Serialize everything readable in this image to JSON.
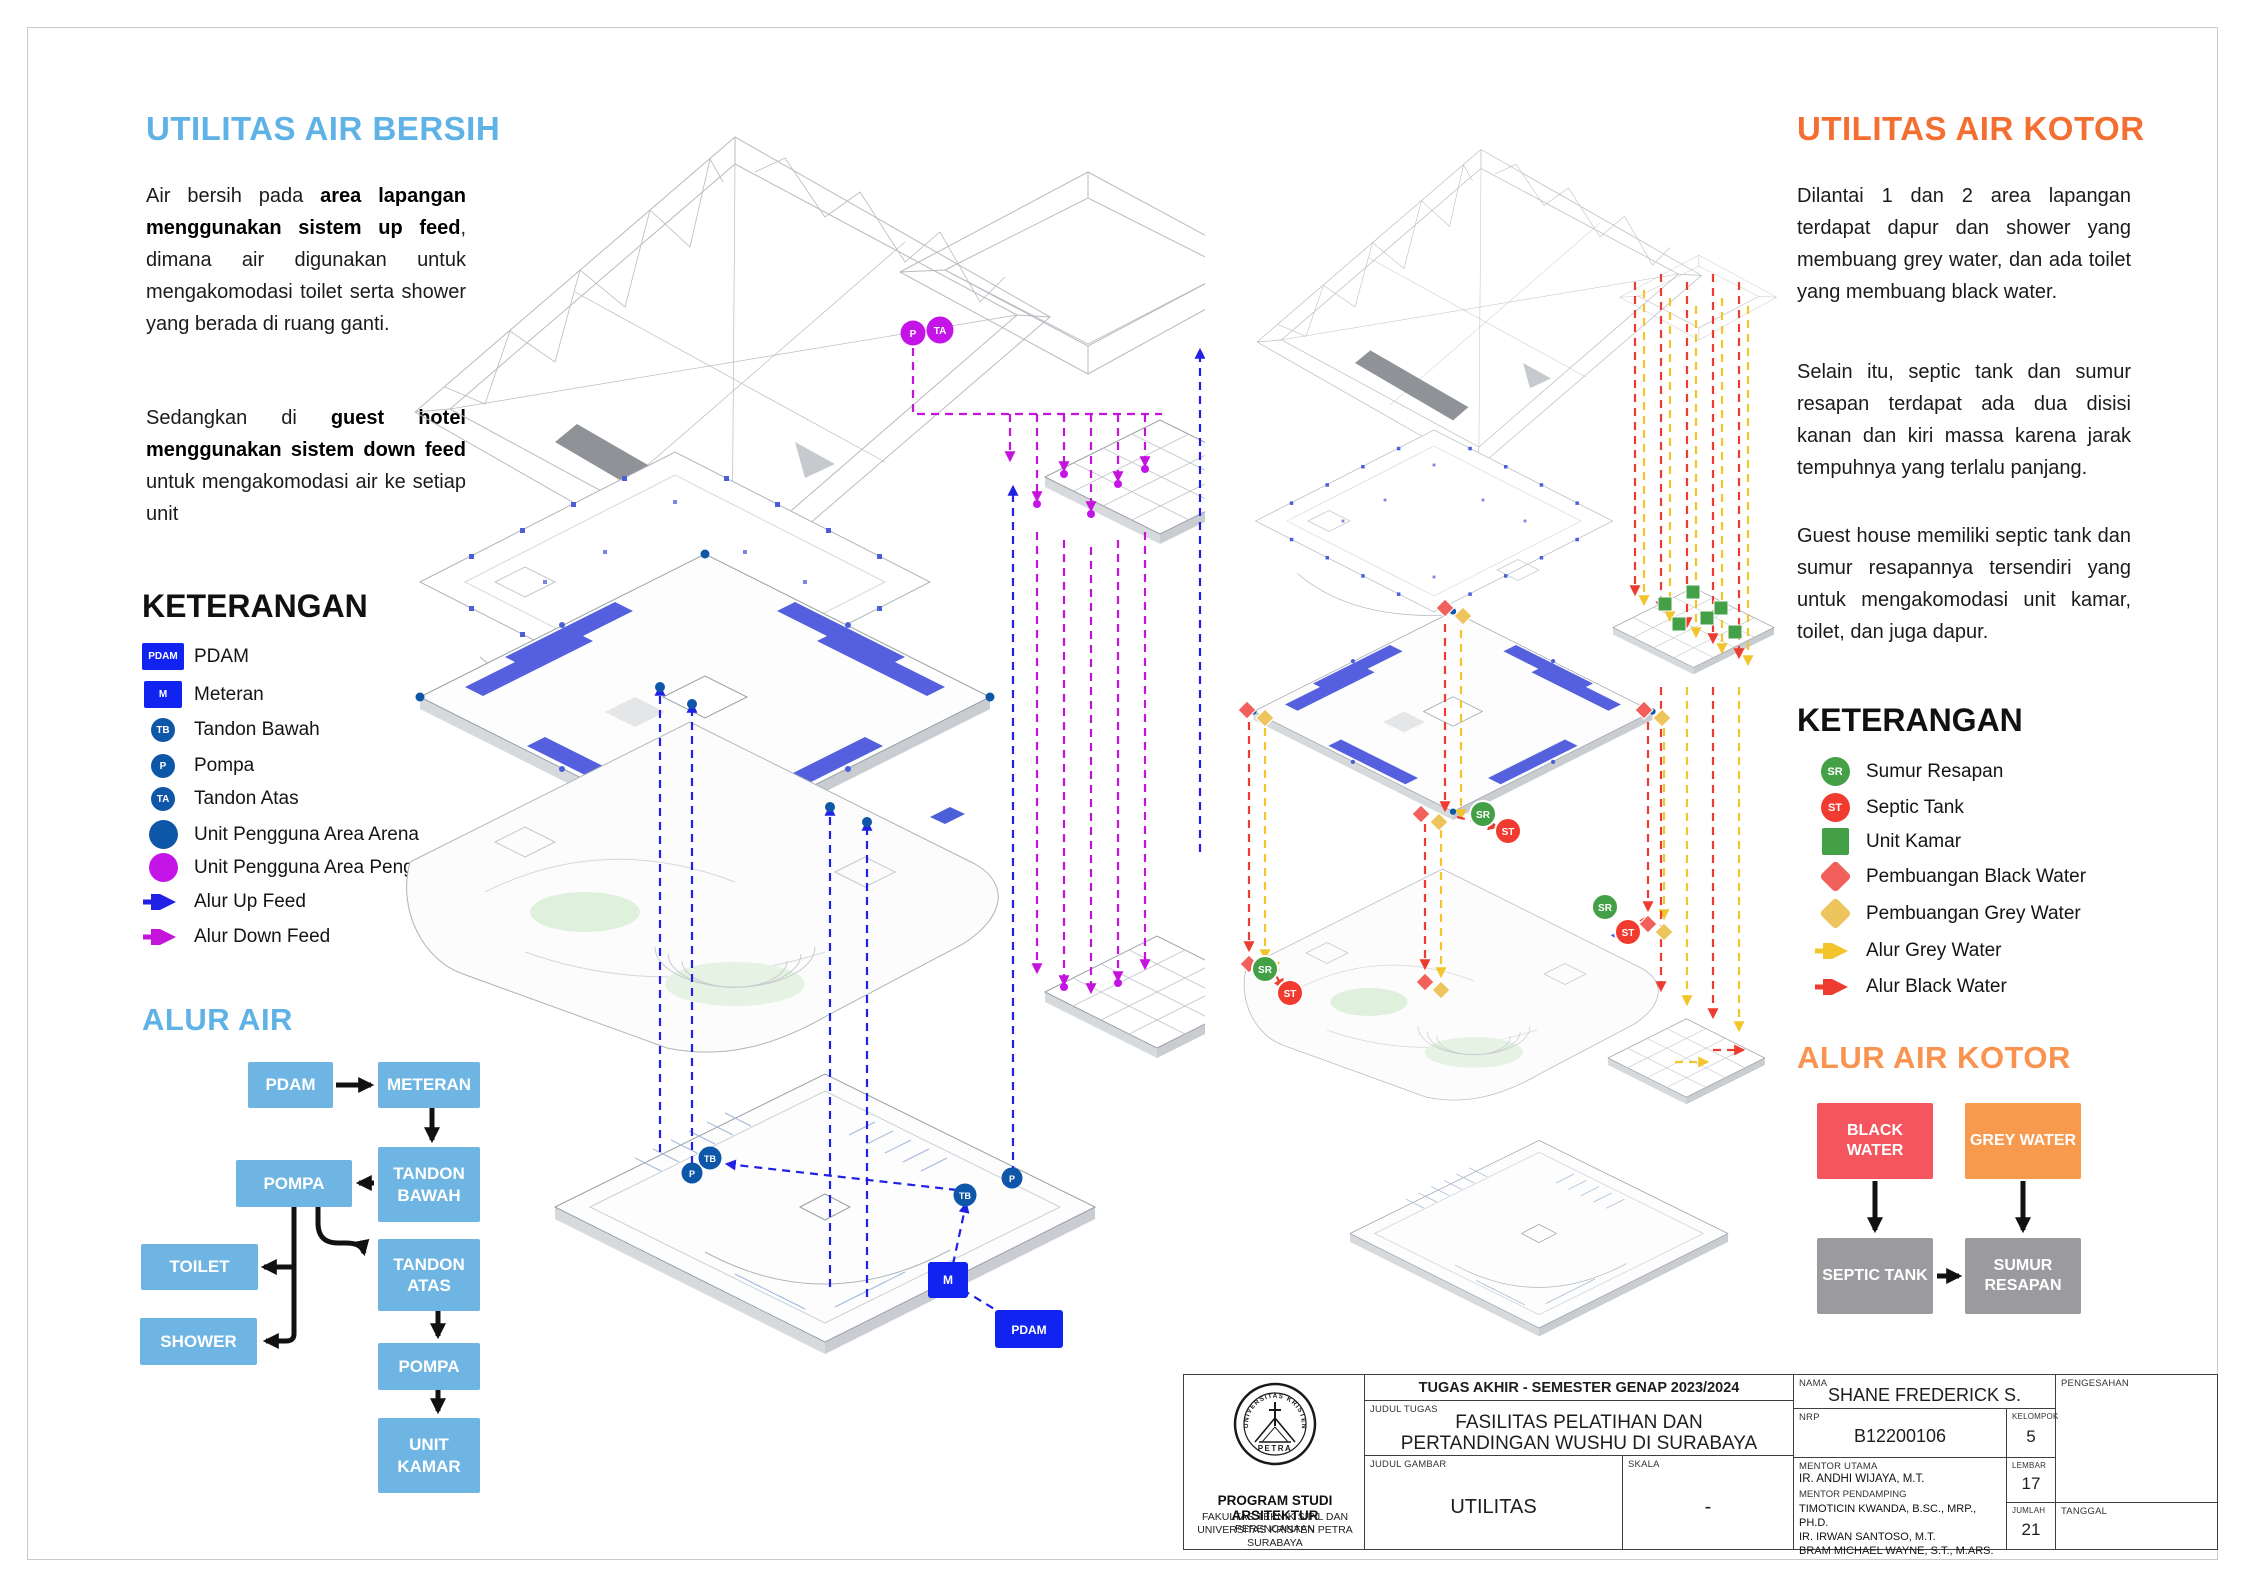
{
  "left_panel": {
    "title": "UTILITAS AIR BERSIH",
    "p1": {
      "a": "Air bersih pada ",
      "b": "area lapangan menggunakan sistem up feed",
      "c": ", dimana air digunakan untuk mengakomodasi toilet serta shower yang berada di ruang ganti."
    },
    "p2": {
      "a": "Sedangkan di ",
      "b": "guest hotel menggunakan sistem down feed",
      "c": " untuk mengakomodasi air ke setiap unit"
    },
    "keterangan_title": "KETERANGAN",
    "legend": [
      {
        "badge": "PDAM",
        "label": "PDAM"
      },
      {
        "badge": "M",
        "label": "Meteran"
      },
      {
        "badge": "TB",
        "label": "Tandon Bawah"
      },
      {
        "badge": "P",
        "label": "Pompa"
      },
      {
        "badge": "TA",
        "label": "Tandon Atas"
      },
      {
        "label": "Unit Pengguna Area Arena"
      },
      {
        "label": "Unit Pengguna Area Penginapan"
      },
      {
        "label": "Alur Up Feed"
      },
      {
        "label": "Alur Down Feed"
      }
    ],
    "alur_title": "ALUR AIR",
    "flow": {
      "pdam": "PDAM",
      "meteran": "METERAN",
      "tandon_bawah": "TANDON BAWAH",
      "pompa1": "POMPA",
      "toilet": "TOILET",
      "shower": "SHOWER",
      "tandon_atas": "TANDON ATAS",
      "pompa2": "POMPA",
      "unit_kamar": "UNIT KAMAR"
    }
  },
  "right_panel": {
    "title": "UTILITAS AIR KOTOR",
    "p1": "Dilantai 1 dan 2 area lapangan terdapat dapur dan shower yang membuang grey water, dan ada toilet yang membuang black water.",
    "p2": "Selain itu, septic tank dan sumur resapan terdapat ada dua disisi kanan dan kiri massa karena jarak tempuhnya yang terlalu panjang.",
    "p3": "Guest house memiliki septic tank dan sumur resapannya tersendiri yang untuk mengakomodasi unit kamar, toilet, dan juga dapur.",
    "keterangan_title": "KETERANGAN",
    "legend": [
      {
        "badge": "SR",
        "label": "Sumur Resapan"
      },
      {
        "badge": "ST",
        "label": "Septic Tank"
      },
      {
        "label": "Unit Kamar"
      },
      {
        "label": "Pembuangan Black Water"
      },
      {
        "label": "Pembuangan Grey Water"
      },
      {
        "label": "Alur Grey Water"
      },
      {
        "label": "Alur Black Water"
      }
    ],
    "alur_title": "ALUR AIR KOTOR",
    "flow": {
      "black_water": "BLACK WATER",
      "grey_water": "GREY WATER",
      "septic_tank": "SEPTIC TANK",
      "sumur_resapan": "SUMUR RESAPAN"
    }
  },
  "markers": {
    "pdam": "PDAM",
    "meteran": "M",
    "tandon_bawah": "TB",
    "pompa": "P",
    "tandon_atas": "TA",
    "sumur_resapan": "SR",
    "septic_tank": "ST"
  },
  "titleblock": {
    "header": "TUGAS AKHIR - SEMESTER GENAP 2023/2024",
    "institution": {
      "program": "PROGRAM STUDI ARSITEKTUR",
      "faculty": "FAKULTAS TEKNIK SIPIL DAN PERENCANAAN",
      "university": "UNIVERSITAS KRISTEN PETRA",
      "city": "SURABAYA"
    },
    "logo_text": {
      "arc": "UNIVERSITAS KRISTEN",
      "banner": "PETRA"
    },
    "labels": {
      "judul_tugas": "JUDUL TUGAS",
      "judul_gambar": "JUDUL GAMBAR",
      "skala": "SKALA",
      "nama": "NAMA",
      "nrp": "NRP",
      "kelompok": "KELOMPOK",
      "mentor_utama": "MENTOR UTAMA",
      "mentor_pendamping": "MENTOR PENDAMPING",
      "lembar": "LEMBAR",
      "jumlah": "JUMLAH",
      "pengesahan": "PENGESAHAN",
      "tanggal": "TANGGAL"
    },
    "values": {
      "judul_tugas": "FASILITAS PELATIHAN DAN PERTANDINGAN WUSHU DI SURABAYA",
      "judul_gambar": "UTILITAS",
      "skala": "-",
      "nama": "SHANE FREDERICK S.",
      "nrp": "B12200106",
      "kelompok": "5",
      "mentor_utama": "IR. ANDHI WIJAYA, M.T.",
      "mentor_pendamping": [
        "TIMOTICIN KWANDA, B.SC., MRP., PH.D.",
        "IR. IRWAN SANTOSO, M.T.",
        "BRAM MICHAEL WAYNE, S.T., M.ARS."
      ],
      "lembar": "17",
      "jumlah": "21"
    }
  },
  "colors": {
    "heading_blue": "#5FB2E6",
    "heading_orange": "#F26F31",
    "flow_blue": "#6FB5E3",
    "pdam_blue": "#1023F0",
    "node_blue": "#0E57A8",
    "guest_magenta": "#C414E8",
    "upfeed": "#2121E6",
    "downfeed": "#C414DC",
    "green": "#43A047",
    "red": "#F23B30",
    "black_water_box": "#F4555E",
    "grey_water_box": "#F79A4D",
    "gray_box": "#9B9B9F",
    "grey_arrow": "#F2C52C",
    "black_arrow": "#EE3B30"
  }
}
